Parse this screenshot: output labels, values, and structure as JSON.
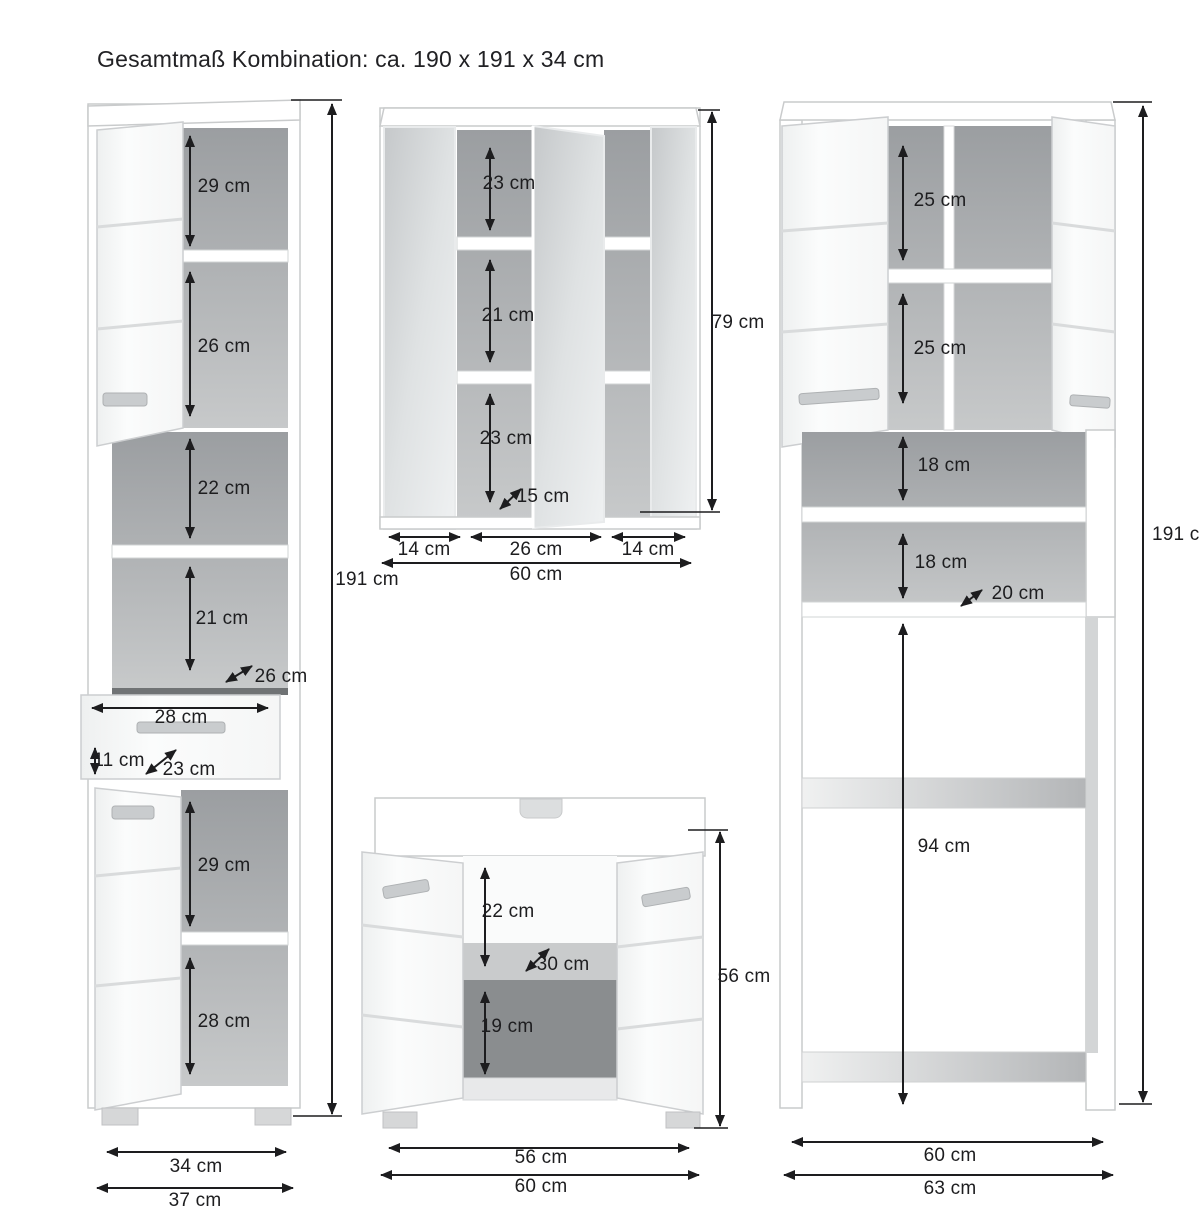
{
  "title": "Gesamtmaß Kombination: ca. 190 x 191 x 34 cm",
  "colors": {
    "dimension_line": "#1d1d1f",
    "interior_gray": "#a9acae",
    "mirror_gray": "#d6d9da",
    "background": "#ffffff"
  },
  "tall_cabinet": {
    "height_label": "191 cm",
    "top_compartment": "29 cm",
    "second_compartment": "26 cm",
    "open_shelf_upper": "22 cm",
    "open_shelf_lower": "21 cm",
    "shelf_depth": "26 cm",
    "drawer_width": "28 cm",
    "drawer_front_height": "11 cm",
    "drawer_depth": "23 cm",
    "lower_compartment_upper": "29 cm",
    "lower_compartment_lower": "28 cm",
    "inner_width": "34 cm",
    "outer_width": "37 cm"
  },
  "mirror_cabinet": {
    "height_label": "79 cm",
    "compartment_1": "23 cm",
    "compartment_2": "21 cm",
    "compartment_3": "23 cm",
    "shelf_depth": "15 cm",
    "left_door_width": "14 cm",
    "middle_width": "26 cm",
    "right_door_width": "14 cm",
    "total_width": "60 cm"
  },
  "sink_cabinet": {
    "height_label": "56 cm",
    "upper_compartment": "22 cm",
    "shelf_depth": "30 cm",
    "lower_compartment": "19 cm",
    "inner_width": "56 cm",
    "total_width": "60 cm"
  },
  "washer_cabinet": {
    "height_label": "191 cm",
    "upper_compartment_1": "25 cm",
    "upper_compartment_2": "25 cm",
    "niche_1": "18 cm",
    "niche_2": "18 cm",
    "niche_depth": "20 cm",
    "washer_opening_height": "94 cm",
    "inner_width": "60 cm",
    "total_width": "63 cm"
  }
}
